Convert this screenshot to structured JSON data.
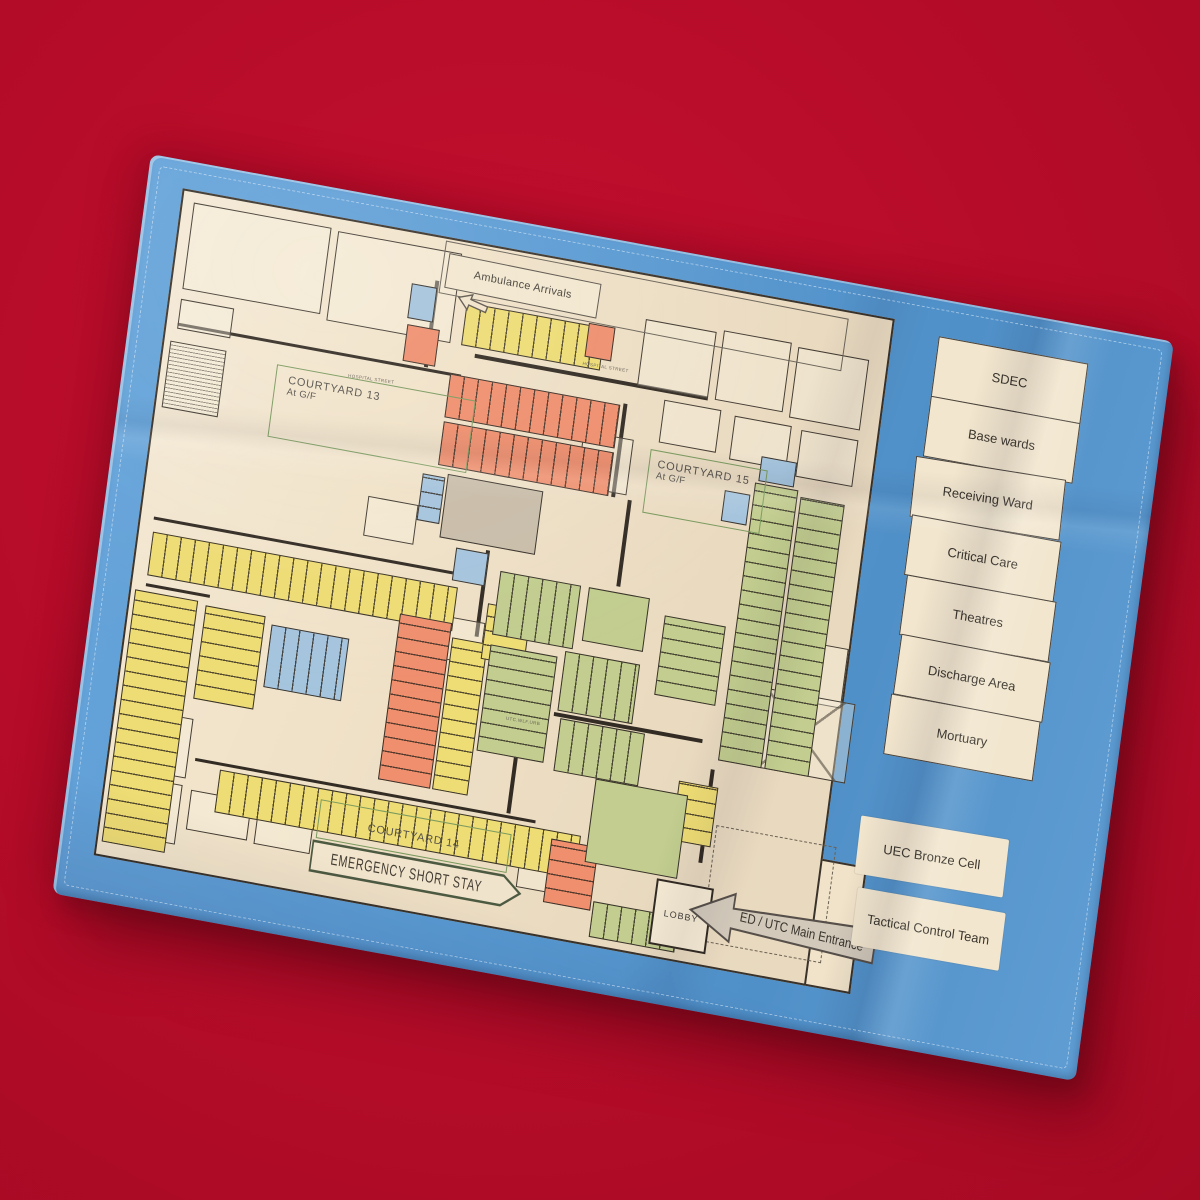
{
  "photo": {
    "background_color": "#b50c29",
    "towel_color": "#5b9bd3",
    "paper_color": "#f1e3c9"
  },
  "room_palette": {
    "yellow": "#eedc74",
    "orange": "#ef8f6e",
    "green": "#c2cd8f",
    "blue": "#a5c4dd",
    "gray": "#c9bda9"
  },
  "map": {
    "labels": {
      "ambulance_arrivals": "Ambulance Arrivals",
      "courtyard_13": "COURTYARD 13",
      "courtyard_13_sub": "At G/F",
      "courtyard_15": "COURTYARD 15",
      "courtyard_15_sub": "At G/F",
      "courtyard_14": "COURTYARD 14",
      "emergency_short_stay": "EMERGENCY SHORT STAY",
      "lobby": "LOBBY",
      "main_entrance": "ED / UTC Main Entrance"
    },
    "street_labels": [
      {
        "text": "HOSPITAL STREET",
        "x": 26,
        "y": 22.3,
        "r": -2
      },
      {
        "text": "HOSPITAL STREET",
        "x": 58,
        "y": 14.2,
        "r": -1
      },
      {
        "text": "UTC.WLF.URB",
        "x": 54,
        "y": 68.6,
        "r": -1
      }
    ],
    "blocks": [
      {
        "color": "blue",
        "x": 33,
        "y": 7.5,
        "w": 3.6,
        "h": 5.2,
        "dir": "none"
      },
      {
        "color": "orange",
        "x": 33.2,
        "y": 13.6,
        "w": 4.6,
        "h": 5.6,
        "dir": "none"
      },
      {
        "color": "yellow",
        "x": 41,
        "y": 8.8,
        "w": 19.5,
        "h": 6.4,
        "dir": "v"
      },
      {
        "color": "orange",
        "x": 58.2,
        "y": 8.6,
        "w": 3.8,
        "h": 5,
        "dir": "none"
      },
      {
        "color": "orange",
        "x": 40,
        "y": 19.8,
        "w": 24,
        "h": 6.6,
        "dir": "v"
      },
      {
        "color": "orange",
        "x": 40,
        "y": 27,
        "w": 24,
        "h": 6.6,
        "dir": "v"
      },
      {
        "color": "gray",
        "x": 41.5,
        "y": 34.6,
        "w": 13.5,
        "h": 9.6,
        "dir": "none"
      },
      {
        "color": "blue",
        "x": 38,
        "y": 35.2,
        "w": 3.2,
        "h": 7,
        "dir": "h"
      },
      {
        "color": "blue",
        "x": 44,
        "y": 45.2,
        "w": 4.6,
        "h": 5,
        "dir": "none"
      },
      {
        "color": "blue",
        "x": 55.5,
        "y": 50,
        "w": 4,
        "h": 6,
        "dir": "h"
      },
      {
        "color": "blue",
        "x": 80,
        "y": 29.5,
        "w": 3.6,
        "h": 4.6,
        "dir": "none"
      },
      {
        "color": "blue",
        "x": 84.5,
        "y": 23.5,
        "w": 5,
        "h": 3.8,
        "dir": "none"
      },
      {
        "color": "green",
        "x": 84,
        "y": 27.5,
        "w": 6.2,
        "h": 42,
        "dir": "h"
      },
      {
        "color": "green",
        "x": 90.6,
        "y": 28.5,
        "w": 6.2,
        "h": 41,
        "dir": "h"
      },
      {
        "color": "yellow",
        "x": 2,
        "y": 51,
        "w": 43,
        "h": 6.6,
        "dir": "v"
      },
      {
        "color": "yellow",
        "x": 0.6,
        "y": 60,
        "w": 8.8,
        "h": 38,
        "dir": "h"
      },
      {
        "color": "yellow",
        "x": 10.5,
        "y": 60.5,
        "w": 8.5,
        "h": 14,
        "dir": "h"
      },
      {
        "color": "blue",
        "x": 20,
        "y": 61.5,
        "w": 11,
        "h": 9.5,
        "dir": "v"
      },
      {
        "color": "orange",
        "x": 37.5,
        "y": 56.5,
        "w": 7.4,
        "h": 25,
        "dir": "h"
      },
      {
        "color": "yellow",
        "x": 45.2,
        "y": 58.5,
        "w": 5,
        "h": 23,
        "dir": "h"
      },
      {
        "color": "yellow",
        "x": 49.5,
        "y": 52.5,
        "w": 6,
        "h": 8.5,
        "dir": "h"
      },
      {
        "color": "yellow",
        "x": 52,
        "y": 62.5,
        "w": 5,
        "h": 7.5,
        "dir": "none"
      },
      {
        "color": "green",
        "x": 50.5,
        "y": 47.5,
        "w": 11.5,
        "h": 9.5,
        "dir": "v"
      },
      {
        "color": "green",
        "x": 63,
        "y": 47.5,
        "w": 8.6,
        "h": 8,
        "dir": "none"
      },
      {
        "color": "green",
        "x": 50.5,
        "y": 58.5,
        "w": 9.5,
        "h": 16,
        "dir": "h"
      },
      {
        "color": "green",
        "x": 61,
        "y": 57.5,
        "w": 10.5,
        "h": 9,
        "dir": "v"
      },
      {
        "color": "green",
        "x": 61.5,
        "y": 67.5,
        "w": 12,
        "h": 8,
        "dir": "v"
      },
      {
        "color": "green",
        "x": 74,
        "y": 49.5,
        "w": 8.6,
        "h": 12,
        "dir": "h"
      },
      {
        "color": "yellow",
        "x": 79,
        "y": 73.5,
        "w": 5.6,
        "h": 9,
        "dir": "h"
      },
      {
        "color": "yellow",
        "x": 15.5,
        "y": 84.3,
        "w": 51,
        "h": 6.4,
        "dir": "v"
      },
      {
        "color": "orange",
        "x": 62.5,
        "y": 85.5,
        "w": 6.6,
        "h": 9.5,
        "dir": "h"
      },
      {
        "color": "green",
        "x": 67.5,
        "y": 75.5,
        "w": 13,
        "h": 12.5,
        "dir": "none"
      },
      {
        "color": "green",
        "x": 69.5,
        "y": 93.5,
        "w": 12,
        "h": 5.4,
        "dir": "v"
      }
    ],
    "outline_rooms": [
      {
        "x": 1.5,
        "y": 1.5,
        "w": 19.5,
        "h": 13
      },
      {
        "x": 22,
        "y": 1.8,
        "w": 17.5,
        "h": 13.5
      },
      {
        "x": 1.5,
        "y": 16,
        "w": 7.5,
        "h": 4.5
      },
      {
        "x": 66,
        "y": 6.5,
        "w": 10,
        "h": 10
      },
      {
        "x": 77,
        "y": 6,
        "w": 9.5,
        "h": 10.5
      },
      {
        "x": 87.5,
        "y": 6.5,
        "w": 10,
        "h": 10.5
      },
      {
        "x": 70,
        "y": 17.8,
        "w": 8,
        "h": 6.4
      },
      {
        "x": 80,
        "y": 18.2,
        "w": 8,
        "h": 6.6
      },
      {
        "x": 89.5,
        "y": 18.6,
        "w": 8,
        "h": 7
      },
      {
        "x": 59.5,
        "y": 24.5,
        "w": 7,
        "h": 8.5
      },
      {
        "x": 93,
        "y": 49.5,
        "w": 7,
        "h": 9
      },
      {
        "x": 0.8,
        "y": 22.5,
        "w": 8,
        "h": 10,
        "style": "hatch"
      },
      {
        "x": 44.5,
        "y": 55.5,
        "w": 5,
        "h": 6.5
      },
      {
        "x": 31,
        "y": 40,
        "w": 7,
        "h": 6
      },
      {
        "x": 2.5,
        "y": 77.5,
        "w": 8.5,
        "h": 9
      },
      {
        "x": 1.2,
        "y": 87.5,
        "w": 9.5,
        "h": 9
      },
      {
        "x": 12,
        "y": 88,
        "w": 8.5,
        "h": 6
      },
      {
        "x": 21.5,
        "y": 88.3,
        "w": 8,
        "h": 6
      },
      {
        "x": 58.5,
        "y": 87.5,
        "w": 6.5,
        "h": 6
      },
      {
        "x": 88,
        "y": 57.5,
        "w": 14,
        "h": 12,
        "style": "xr"
      },
      {
        "x": 85,
        "y": 79,
        "w": 17,
        "h": 17.5,
        "style": "dashed"
      }
    ],
    "walls": [
      {
        "x": 1.5,
        "y": 19.6,
        "w": 40,
        "h": 0.5
      },
      {
        "x": 43,
        "y": 16.2,
        "w": 33,
        "h": 0.5
      },
      {
        "x": 1.8,
        "y": 48.8,
        "w": 43,
        "h": 0.5
      },
      {
        "x": 36.3,
        "y": 6.5,
        "w": 0.55,
        "h": 13
      },
      {
        "x": 64.5,
        "y": 19.5,
        "w": 0.55,
        "h": 14
      },
      {
        "x": 48.2,
        "y": 44.8,
        "w": 0.55,
        "h": 13
      },
      {
        "x": 12,
        "y": 83.2,
        "w": 48,
        "h": 0.5
      },
      {
        "x": 60.5,
        "y": 66.8,
        "w": 21,
        "h": 0.5
      },
      {
        "x": 83.2,
        "y": 71,
        "w": 0.55,
        "h": 14
      },
      {
        "x": 66.8,
        "y": 33.5,
        "w": 0.55,
        "h": 13
      },
      {
        "x": 55.8,
        "y": 67,
        "w": 0.55,
        "h": 16
      },
      {
        "x": 2,
        "y": 58.8,
        "w": 9,
        "h": 0.5
      }
    ]
  },
  "legend": {
    "items": [
      "SDEC",
      "Base wards",
      "Receiving Ward",
      "Critical Care",
      "Theatres",
      "Discharge Area",
      "Mortuary"
    ]
  },
  "callouts": {
    "uec": "UEC Bronze Cell",
    "tactical": "Tactical Control Team"
  }
}
